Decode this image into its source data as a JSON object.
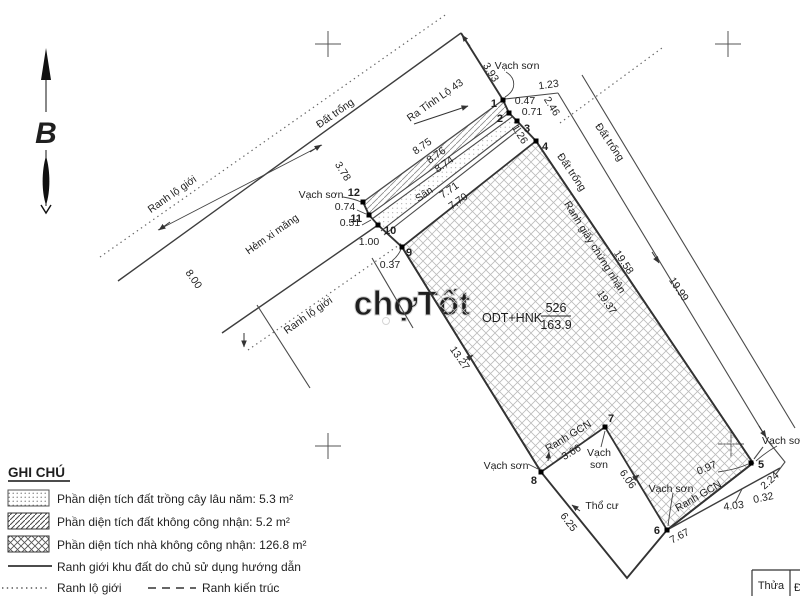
{
  "drawing": {
    "north_label": "B",
    "watermark": "chợTốt",
    "parcel": {
      "land_use_code": "ODT+HNK",
      "plot_number": "526",
      "area_m2": "163.9"
    },
    "labels": {
      "dat_trong": "Đất trống",
      "ranh_lo_gioi": "Ranh lộ giới",
      "hem_xi_mang": "Hẻm xi măng",
      "ra_tinh_lo_43": "Ra Tỉnh Lộ 43",
      "vach_son": "Vạch sơn",
      "vach_son_line1": "Vạch",
      "vach_son_line2": "sơn",
      "vach_son_clipped": "Vạch sơ",
      "ranh_gcn": "Ranh GCN",
      "ranh_giay_chung_nhan": "Ranh giấy chứng nhận",
      "san": "Sân",
      "tho_cu": "Thổ cư"
    },
    "points": {
      "p1": "1",
      "p2": "2",
      "p3": "3",
      "p4": "4",
      "p5": "5",
      "p6": "6",
      "p7": "7",
      "p8": "8",
      "p9": "9",
      "p10": "10",
      "p11": "11",
      "p12": "12"
    },
    "measurements": {
      "m3_93": "3.93",
      "m1_23": "1.23",
      "m0_47": "0.47",
      "m0_71": "0.71",
      "m2_46": "2.46",
      "m1_26": "1.26",
      "m8_75": "8.75",
      "m8_76": "8.76",
      "m8_74": "8.74",
      "m7_71": "7.71",
      "m7_70": "7.70",
      "m3_78": "3.78",
      "m0_74": "0.74",
      "m0_51": "0.51",
      "m1_00": "1.00",
      "m0_37": "0.37",
      "m8_00": "8.00",
      "m13_27": "13.27",
      "m19_37": "19.37",
      "m19_58": "19.58",
      "m19_99": "19.99",
      "m3_66": "3.66",
      "m6_06": "6.06",
      "m6_25": "6.25",
      "m7_67": "7.67",
      "m4_03": "4.03",
      "m0_97": "0.97",
      "m2_24": "2.24",
      "m0_32": "0.32"
    }
  },
  "legend": {
    "title": "GHI CHÚ",
    "items": [
      {
        "swatch": "dots",
        "label": "Phần diện tích đất trồng cây lâu năm: 5.3 m²"
      },
      {
        "swatch": "diagonal-hatch",
        "label": "Phần diện tích đất không công nhận: 5.2 m²"
      },
      {
        "swatch": "cross-hatch",
        "label": "Phần diện tích nhà không công nhận: 126.8 m²"
      },
      {
        "swatch": "solid-line",
        "label": "Ranh giới khu đất do chủ sử dụng hướng dẫn"
      },
      {
        "swatch": "dotted-line",
        "label": "Ranh lộ giới"
      },
      {
        "swatch": "dashed-line",
        "label": "Ranh kiến trúc"
      }
    ]
  },
  "table": {
    "header_thua": "Thửa",
    "header_partial": "Đ"
  }
}
